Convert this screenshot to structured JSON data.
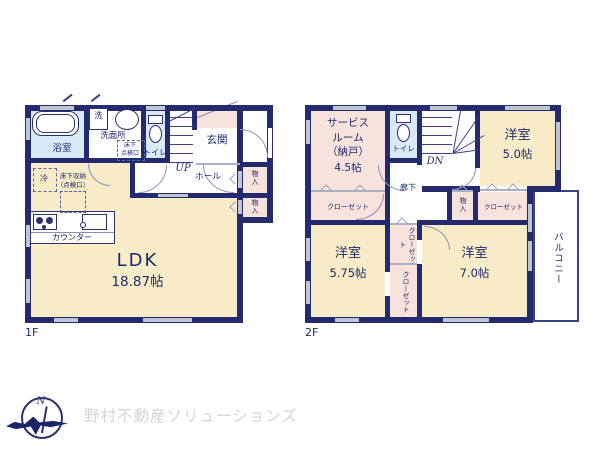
{
  "floor1": {
    "label": "1F",
    "ldk_name": "LDK",
    "ldk_size": "18.87帖",
    "bath": "浴室",
    "washer": "洗",
    "washroom": "洗面所",
    "underfloor_hatch": "床下\n点検口",
    "toilet": "トイレ",
    "stairs_up": "UP",
    "entrance": "玄関",
    "hall": "ホール",
    "storage_upper": "物入",
    "storage_lower": "物入",
    "fridge": "冷",
    "underfloor_storage": "床下収納\n（点検口）",
    "counter": "カウンター"
  },
  "floor2": {
    "label": "2F",
    "service_room_name": "サービス\nルーム\n（納戸）",
    "service_room_size": "4.5帖",
    "toilet": "トイレ",
    "stairs_dn": "DN",
    "room5_name": "洋室",
    "room5_size": "5.0帖",
    "corridor": "廊下",
    "closet_left": "クローゼット",
    "storage": "物入",
    "closet_right": "クローゼット",
    "room575_name": "洋室",
    "room575_size": "5.75帖",
    "closet_mid_upper": "クローゼット",
    "closet_mid_lower": "クローゼット",
    "room7_name": "洋室",
    "room7_size": "7.0帖",
    "balcony": "バルコニー"
  },
  "branding": {
    "company": "野村不動産ソリューションズ",
    "compass_north": "N"
  },
  "colors": {
    "wall_navy": "#232a6d",
    "floor_cream": "#f8ecc8",
    "closet_pink": "#f8e2dc",
    "wet_blue": "#d9e9f5",
    "window_gray": "#bfc5d1",
    "logo_gray": "#d5d5d5"
  }
}
